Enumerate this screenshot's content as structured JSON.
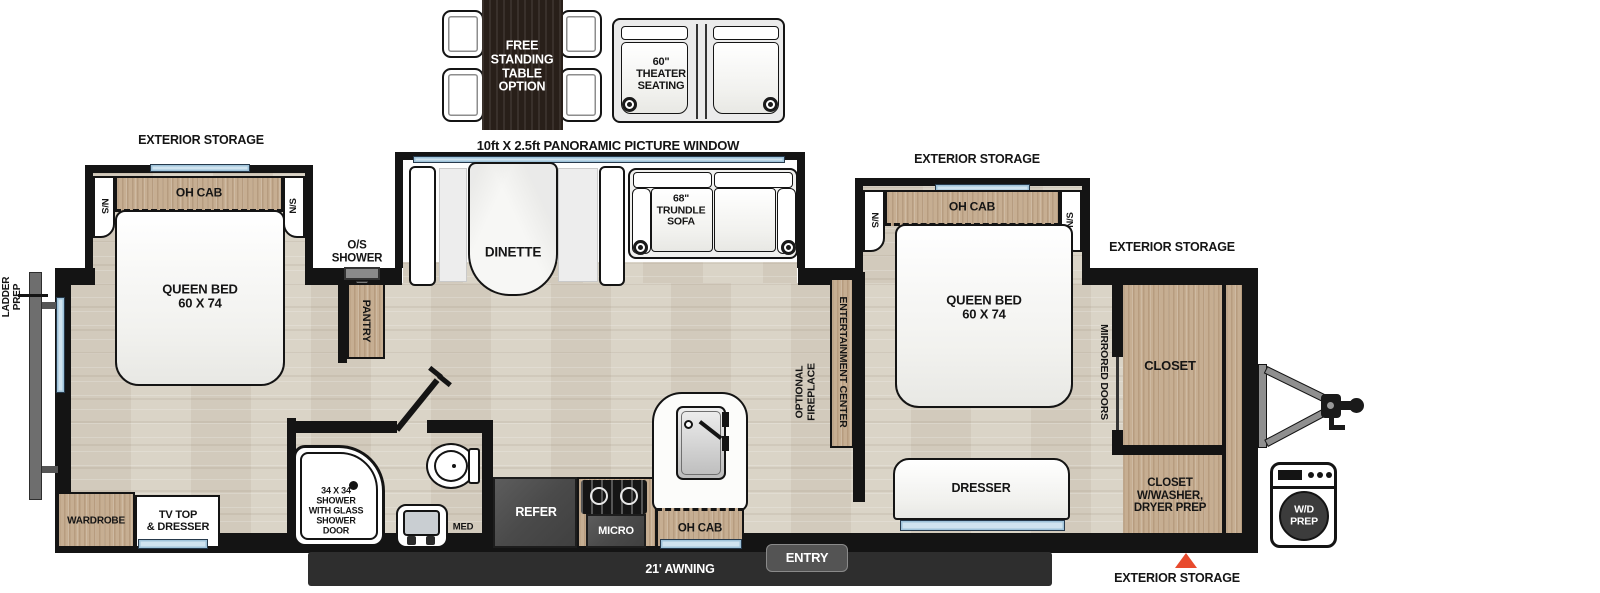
{
  "colors": {
    "wall": "#141414",
    "floor_wood": "#d8d1c4",
    "cabinet_wood": "#c6ae92",
    "table_dark_wood": "#281f19",
    "window_blue": "#cfe3ef",
    "accent_red": "#e84a2d",
    "appliance_gray": "#4a4a4a",
    "awning_dark": "#2e2e2e"
  },
  "optional_items": {
    "free_standing_table": "FREE\nSTANDING\nTABLE\nOPTION",
    "theater_seating": "60\"\nTHEATER\nSEATING"
  },
  "callouts": {
    "exterior_storage": "EXTERIOR STORAGE",
    "panoramic_window": "10ft X 2.5ft PANORAMIC PICTURE WINDOW",
    "ladder_prep": "LADDER\nPREP",
    "os_shower": "O/S\nSHOWER",
    "entry": "ENTRY",
    "awning": "21' AWNING"
  },
  "rear_bedroom": {
    "ns": "N/S",
    "oh_cab": "OH CAB",
    "queen_bed": "QUEEN BED\n60 X 74",
    "wardrobe": "WARDROBE",
    "tv_dresser": "TV TOP\n& DRESSER"
  },
  "bathroom": {
    "shower": "34 X 34\nSHOWER\nWITH GLASS\nSHOWER\nDOOR",
    "med_cab": "MED\nCAB"
  },
  "kitchen": {
    "pantry": "PANTRY",
    "refer": "REFER",
    "micro": "MICRO",
    "oh_cab": "OH CAB",
    "dinette": "DINETTE",
    "trundle_sofa": "68\"\nTRUNDLE\nSOFA"
  },
  "living": {
    "entertainment_center": "ENTERTAINMENT CENTER",
    "optional_fireplace": "OPTIONAL\nFIREPLACE"
  },
  "front_bedroom": {
    "ns": "N/S",
    "oh_cab": "OH CAB",
    "queen_bed": "QUEEN BED\n60 X 74",
    "dresser": "DRESSER",
    "mirrored_doors": "MIRRORED DOORS",
    "closet": "CLOSET",
    "closet_washer": "CLOSET\nW/WASHER,\nDRYER PREP",
    "wd_prep": "W/D\nPREP"
  }
}
